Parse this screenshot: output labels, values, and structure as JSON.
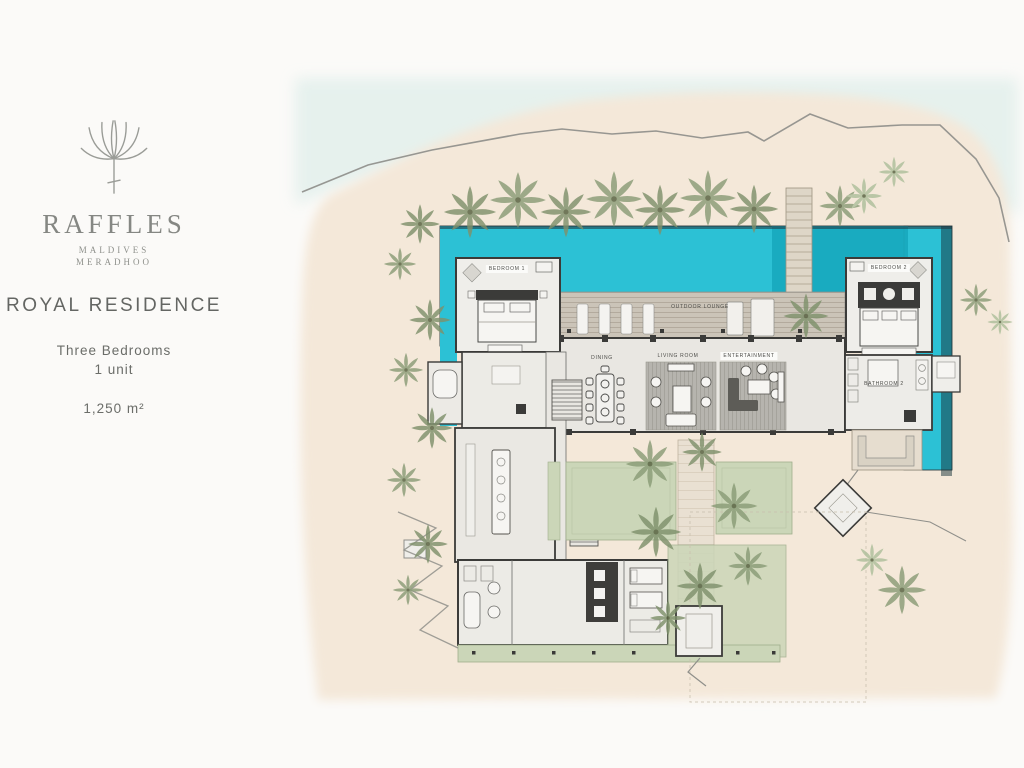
{
  "page": {
    "title": "Raffles Maldives Meradhoo — Royal Residence floor plan"
  },
  "sidebar": {
    "brand_name": "RAFFLES",
    "brand_sub1": "MALDIVES",
    "brand_sub2": "MERADHOO",
    "residence_title": "ROYAL RESIDENCE",
    "detail_line1": "Three Bedrooms",
    "detail_line2": "1 unit",
    "area": "1,250 m²"
  },
  "plan": {
    "labels": {
      "bedroom1": "BEDROOM 1",
      "bedroom2": "BEDROOM 2",
      "bathroom2": "BATHROOM 2",
      "outdoor_lounge": "OUTDOOR LOUNGE",
      "dining": "DINING",
      "living_room": "LIVING ROOM",
      "entertainment": "ENTERTAINMENT"
    },
    "colors": {
      "pool": "#2cc1d5",
      "pool_shadow": "#18aabf",
      "sand": "#f4e8d9",
      "water_wash": "#dfeeea",
      "lawn": "#cbd6b8",
      "deck": "#c9c2b6",
      "walkway": "#e9e0d2",
      "palm_dark": "#7f916c",
      "palm_light": "#aebf9b",
      "wall": "#3b3b39"
    }
  }
}
